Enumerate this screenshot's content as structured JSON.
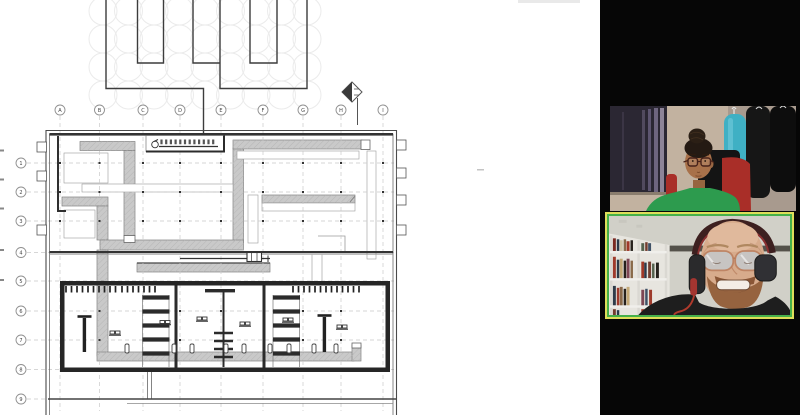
{
  "screen_share": {
    "drawing": {
      "column_labels": [
        "A",
        "B",
        "C",
        "D",
        "E",
        "F",
        "G",
        "H",
        "I"
      ],
      "row_labels": [
        "1",
        "2",
        "3",
        "4",
        "5",
        "6",
        "7",
        "8",
        "9"
      ],
      "line_color": "#3c3c3c",
      "band_color": "#c9c9c9"
    }
  },
  "participants_panel": {
    "bg_color": "#060606",
    "tiles": [
      {
        "id": "participant-1",
        "active_speaker": false
      },
      {
        "id": "participant-2",
        "active_speaker": true
      }
    ],
    "active_speaker_border": {
      "outer": "#dede5a",
      "inner": "#46b04a"
    }
  }
}
